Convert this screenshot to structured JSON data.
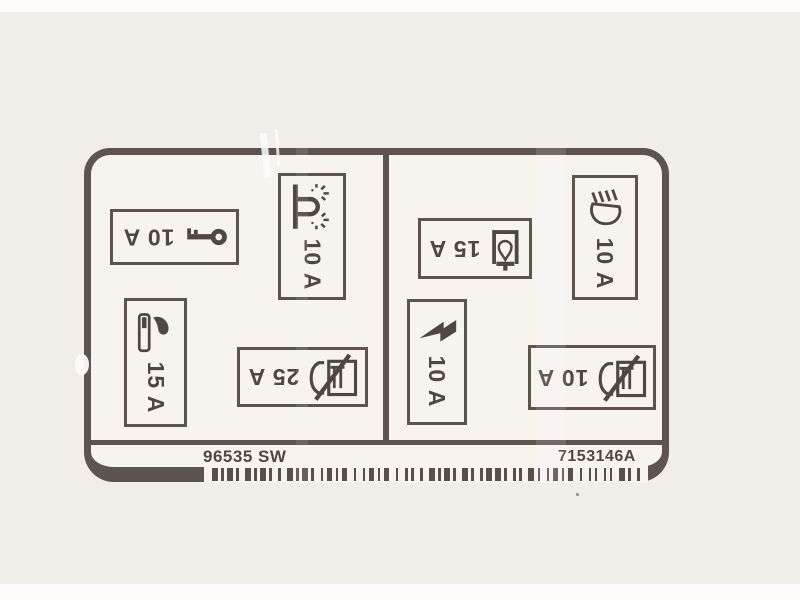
{
  "label": {
    "sections": {
      "left": {
        "fuses": [
          {
            "id": "ignition-key",
            "icon": "key-icon",
            "rating": "10 A"
          },
          {
            "id": "cigarette-lighter",
            "icon": "cigarette-lighter-icon",
            "rating": "15 A"
          },
          {
            "id": "parking-light",
            "icon": "parking-light-icon",
            "rating": "10 A"
          },
          {
            "id": "crossed-device-25",
            "icon": "crossed-device-icon",
            "rating": "25 A"
          }
        ]
      },
      "right": {
        "fuses": [
          {
            "id": "interior-bulb",
            "icon": "bulb-icon",
            "rating": "15 A"
          },
          {
            "id": "headlight",
            "icon": "headlight-icon",
            "rating": "10 A"
          },
          {
            "id": "lightning",
            "icon": "lightning-bolt-icon",
            "rating": "10 A"
          },
          {
            "id": "crossed-device-10",
            "icon": "crossed-device-icon",
            "rating": "10 A"
          }
        ]
      }
    },
    "footer": {
      "left_code": "96535 SW",
      "right_code": "7153146A"
    },
    "barcode": {
      "pattern": "2111211221112112122111211211211122121121112212111212211121122112112121121112211211211122121112111221121"
    }
  },
  "colors": {
    "ink": "#5d5450",
    "ink_secondary": "#4e4743",
    "label_bg": "#f7f3ef",
    "page_bg": "#f1ede9",
    "barcode": "#56504c"
  }
}
